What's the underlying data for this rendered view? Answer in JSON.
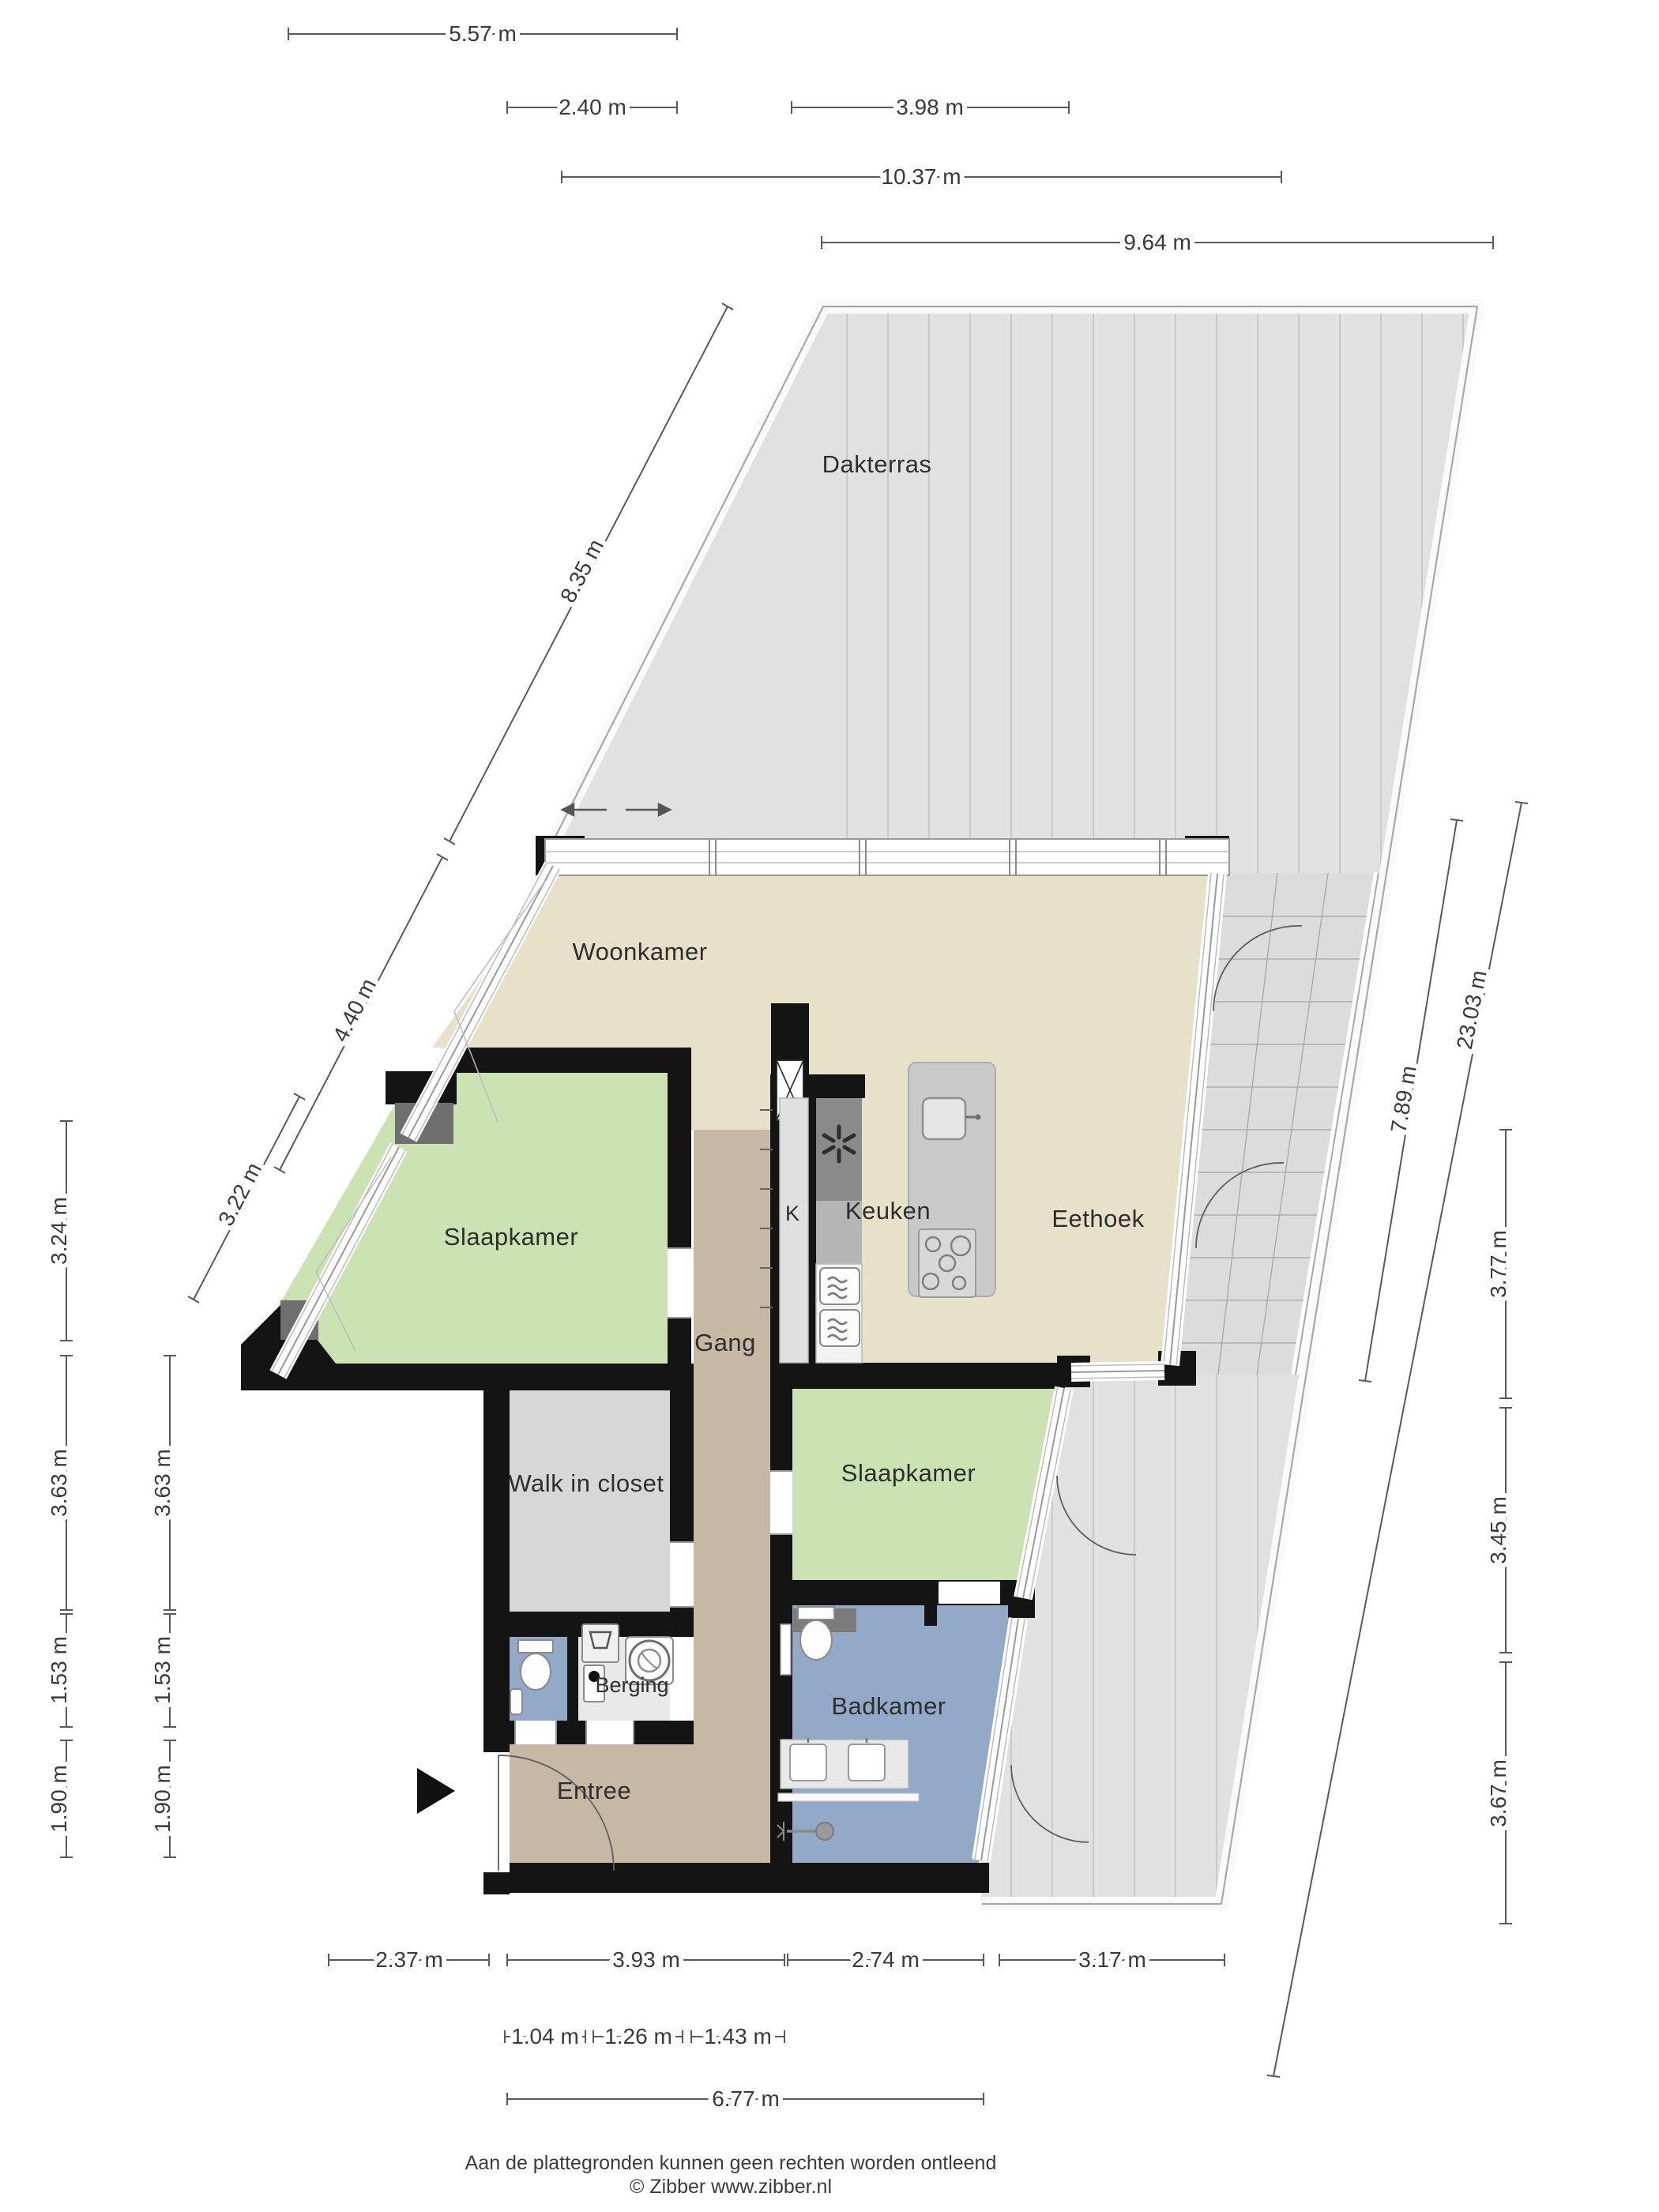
{
  "rooms": {
    "dakterras": "Dakterras",
    "woonkamer": "Woonkamer",
    "slaapkamer_links": "Slaapkamer",
    "kast": "K",
    "keuken": "Keuken",
    "eethoek": "Eethoek",
    "gang": "Gang",
    "walk_in_closet": "Walk in closet",
    "slaapkamer_rechts": "Slaapkamer",
    "berging": "Berging",
    "badkamer": "Badkamer",
    "entree": "Entree"
  },
  "dimensions": {
    "top": [
      "5.57 m",
      "2.40 m",
      "3.98 m",
      "10.37 m",
      "9.64 m"
    ],
    "left_diagonal": [
      "8.35 m",
      "4.40 m",
      "3.22 m"
    ],
    "left_column_outer": [
      "3.24 m",
      "3.63 m",
      "1.53 m",
      "1.90 m"
    ],
    "left_column_inner": [
      "3.63 m",
      "1.53 m",
      "1.90 m"
    ],
    "right_diagonal": [
      "7.89 m",
      "23.03 m"
    ],
    "right_column": [
      "3.77 m",
      "3.45 m",
      "3.67 m"
    ],
    "bottom_row1": [
      "2.37 m",
      "3.93 m",
      "2.74 m",
      "3.17 m"
    ],
    "bottom_row2": [
      "1.04 m",
      "1.26 m",
      "1.43 m"
    ],
    "bottom_total": "6.77 m"
  },
  "footer": {
    "disclaimer": "Aan de plattegronden kunnen geen rechten worden ontleend",
    "copyright": "© Zibber www.zibber.nl"
  },
  "colors": {
    "living_floor": "#e8e1c9",
    "hall_floor": "#c7b8a5",
    "bedroom_floor": "#cbe2b3",
    "closet_floor": "#d7d7d7",
    "bathroom_floor": "#92a9c7",
    "terrace": "#e1e1e1",
    "stairs": "#dcdcdc",
    "wall": "#141414"
  }
}
